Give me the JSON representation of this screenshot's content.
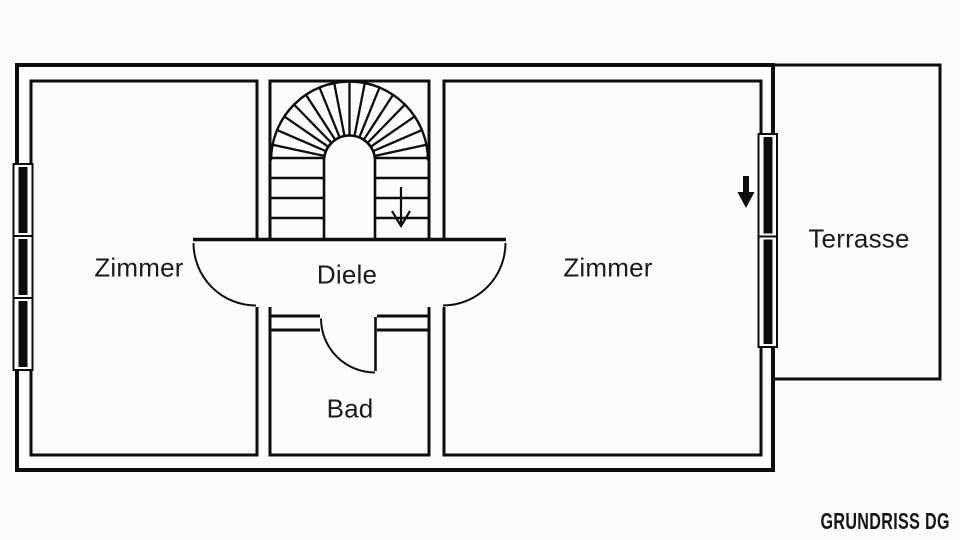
{
  "colors": {
    "background": "#fcfcfd",
    "line": "#0d0d0d",
    "text": "#1b1b1b"
  },
  "floor_plan": {
    "rooms": [
      {
        "id": "zimmer-left",
        "label": "Zimmer"
      },
      {
        "id": "diele",
        "label": "Diele"
      },
      {
        "id": "zimmer-right",
        "label": "Zimmer"
      },
      {
        "id": "bad",
        "label": "Bad"
      },
      {
        "id": "terrasse",
        "label": "Terrasse"
      }
    ],
    "caption": "GRUNDRISS DG",
    "icons": [
      {
        "name": "stairs-down-arrow-icon",
        "meaning": "stair direction down"
      },
      {
        "name": "terrace-door-arrow-icon",
        "meaning": "exit direction to terrace"
      }
    ]
  }
}
